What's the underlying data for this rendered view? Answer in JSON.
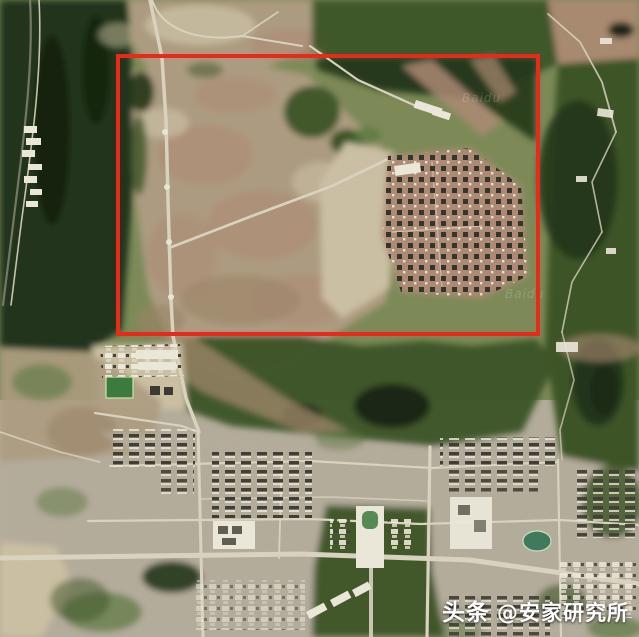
{
  "image": {
    "kind": "satellite-photo",
    "width_px": 639,
    "height_px": 637
  },
  "annotation": {
    "shape": "rectangle",
    "x": 118,
    "y": 56,
    "width": 420,
    "height": 278,
    "stroke_width": 4,
    "color": "#e8291c"
  },
  "tile_watermark": {
    "text": "Baidu"
  },
  "watermark": {
    "prefix": "头条",
    "handle": "@安家研究所",
    "color": "#ffffff"
  },
  "palette": {
    "forest_dark": "#22361a",
    "forest_darker": "#16240f",
    "forest_mid": "#3c5426",
    "forest_light": "#5b7840",
    "scrub_base": "#7d8a58",
    "bare_tan": "#ac9b80",
    "bare_pale": "#cbbfa3",
    "bare_pink": "#ad8a74",
    "bare_brown": "#9b8468",
    "road_light": "#d8d2be",
    "urban_ground": "#b4ac9b",
    "building_dark": "#3d3b31",
    "building_white": "#eae7d9",
    "water_dark": "#1c2812",
    "field_green": "#3d7a3e",
    "stadium_green": "#40795c",
    "annotation_red": "#e8291c",
    "watermark_white": "#ffffff"
  }
}
